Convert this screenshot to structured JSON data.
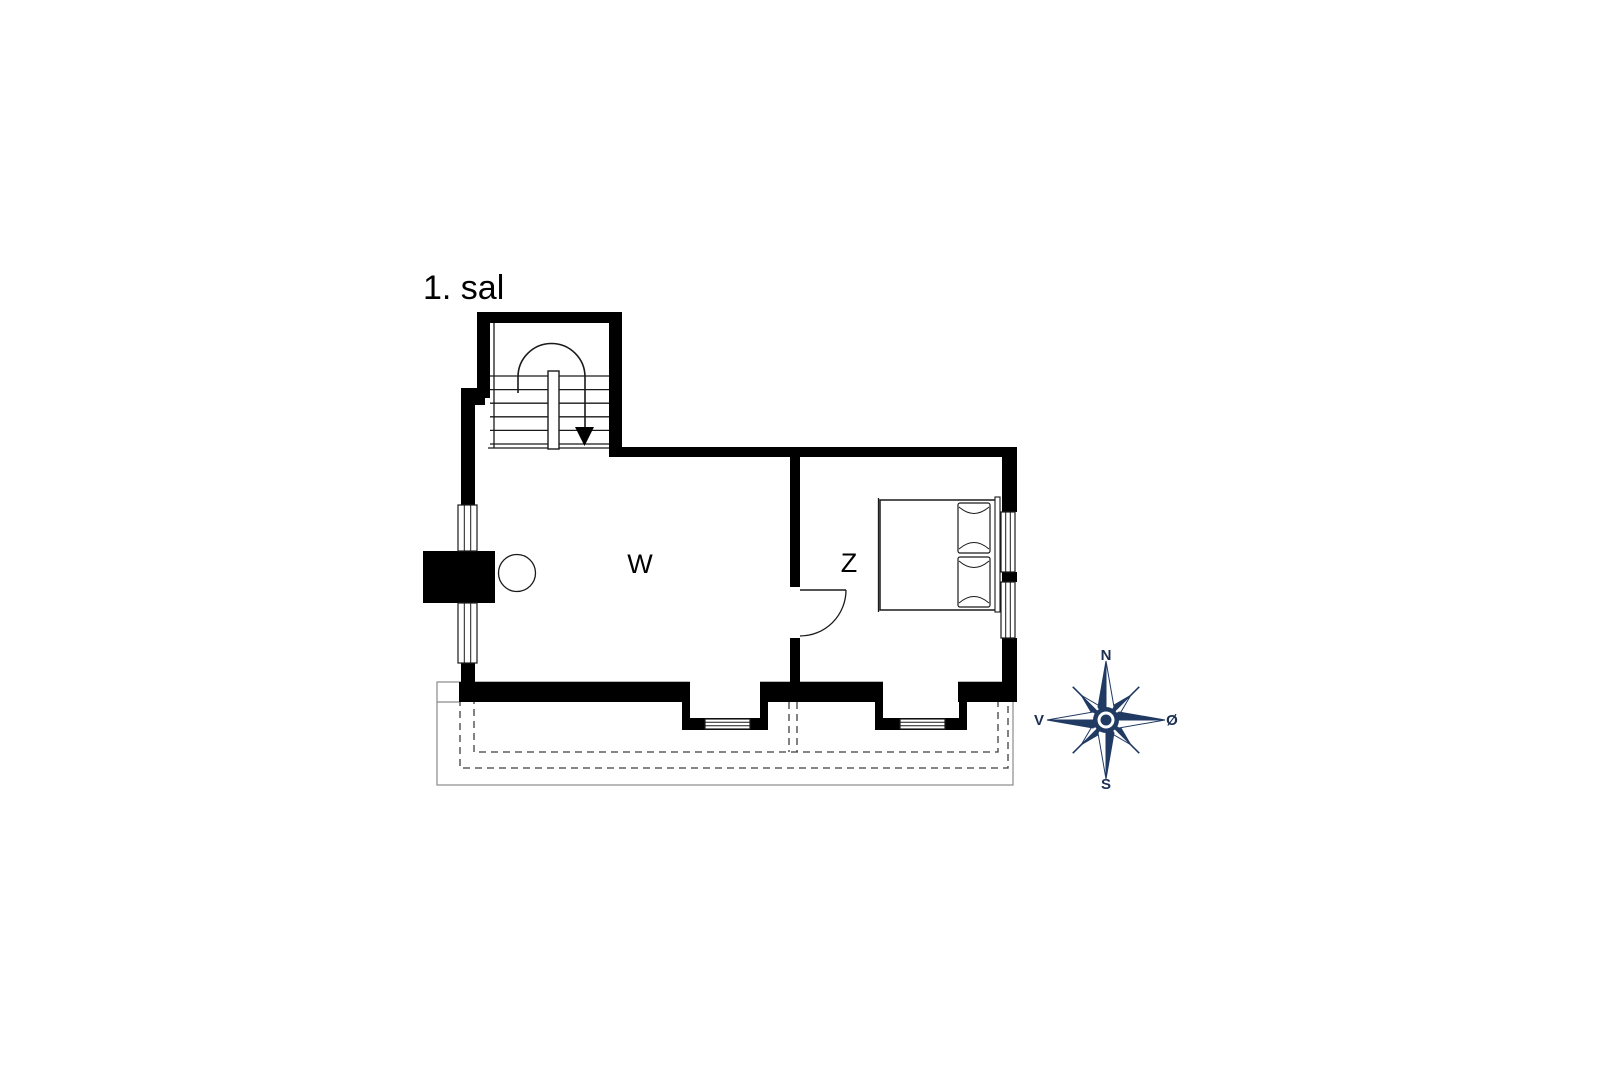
{
  "floor_plan": {
    "title": "1. sal",
    "room_w_label": "W",
    "room_z_label": "Z"
  },
  "compass": {
    "north": "N",
    "south": "S",
    "west": "V",
    "east": "Ø"
  },
  "colors": {
    "background": "#ffffff",
    "wall": "#000000",
    "line": "#1a1a1a",
    "roof": "#8a8a8a",
    "dash": "#3f3f3f",
    "navy": "#203a64",
    "navy_dark": "#1b2f52"
  }
}
